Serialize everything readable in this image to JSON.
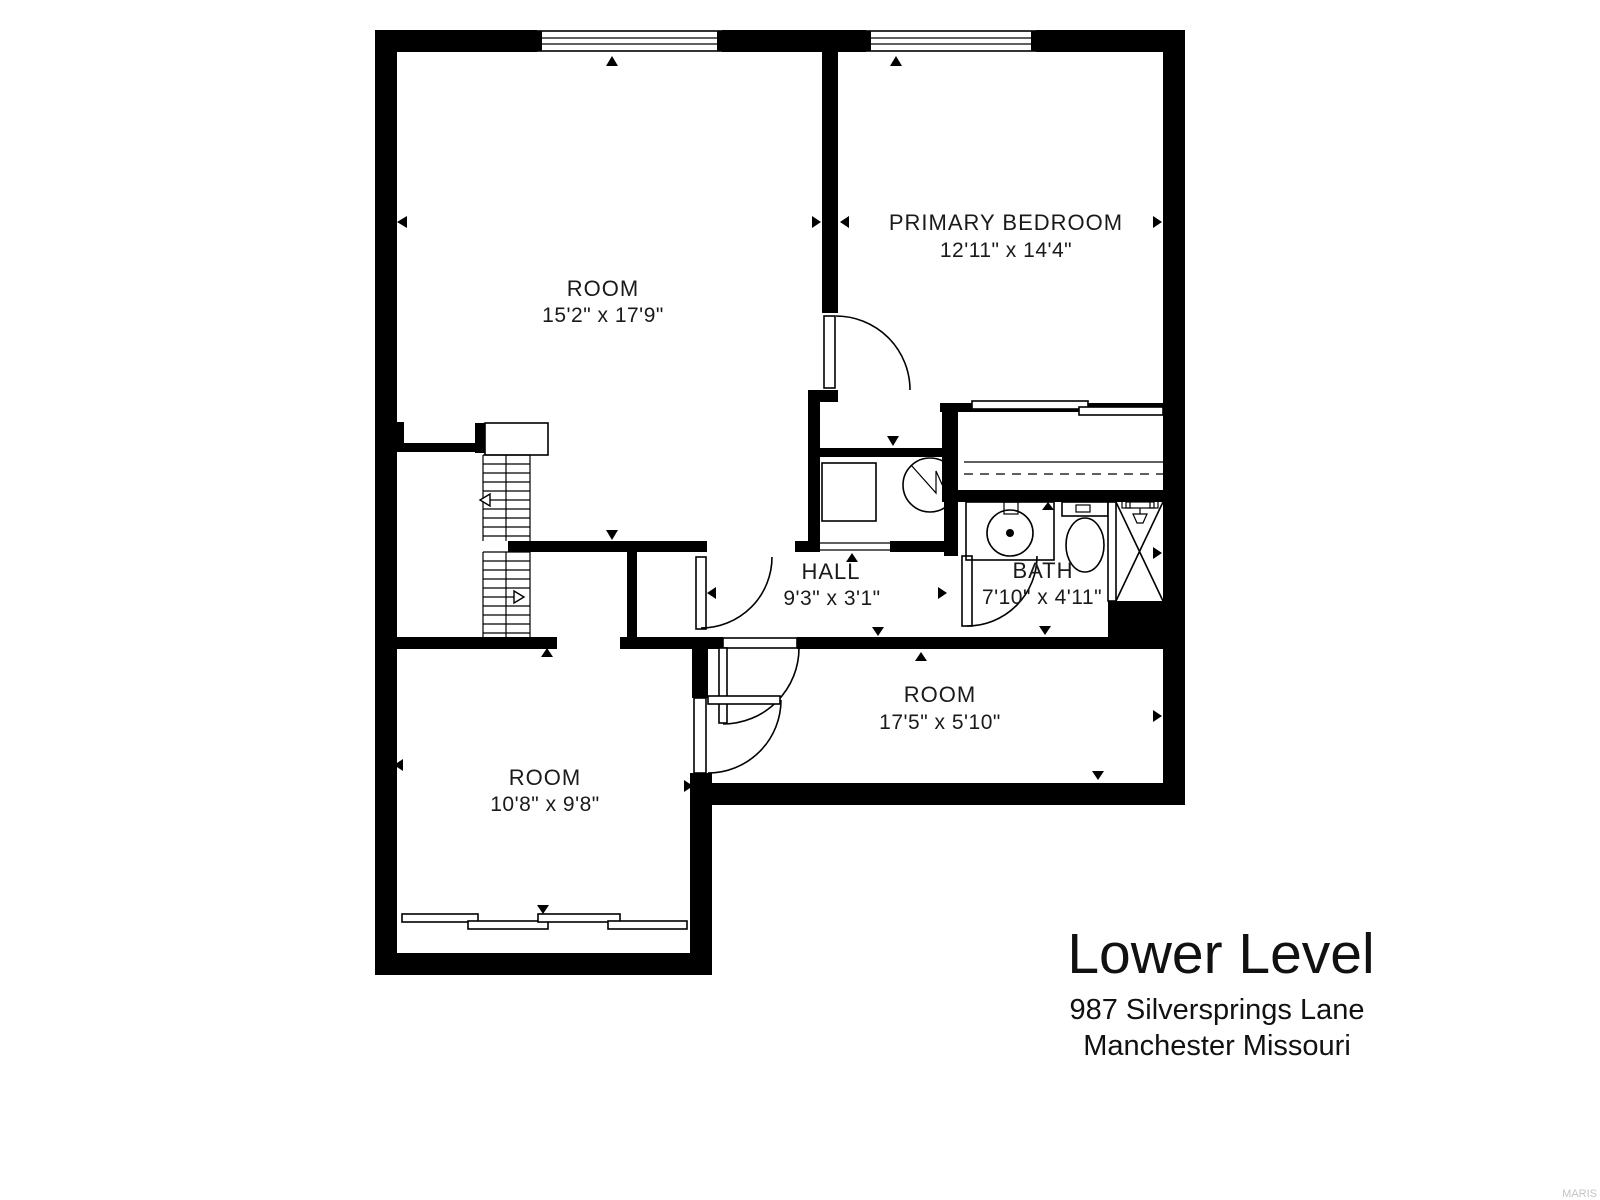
{
  "labels": {
    "room_main": {
      "name": "ROOM",
      "dims": "15'2\" x 17'9\""
    },
    "primary_bedroom": {
      "name": "PRIMARY BEDROOM",
      "dims": "12'11\" x 14'4\""
    },
    "hall": {
      "name": "HALL",
      "dims": "9'3\" x 3'1\""
    },
    "bath": {
      "name": "BATH",
      "dims": "7'10\" x 4'11\""
    },
    "room_mid": {
      "name": "ROOM",
      "dims": "17'5\" x 5'10\""
    },
    "room_lower": {
      "name": "ROOM",
      "dims": "10'8\" x 9'8\""
    }
  },
  "title_block": {
    "title": "Lower Level",
    "address_line1": "987 Silversprings Lane",
    "address_line2": "Manchester Missouri"
  },
  "watermark": "MARIS",
  "colors": {
    "wall": "#000000",
    "background": "#ffffff",
    "watermark": "#c4c4c4"
  }
}
